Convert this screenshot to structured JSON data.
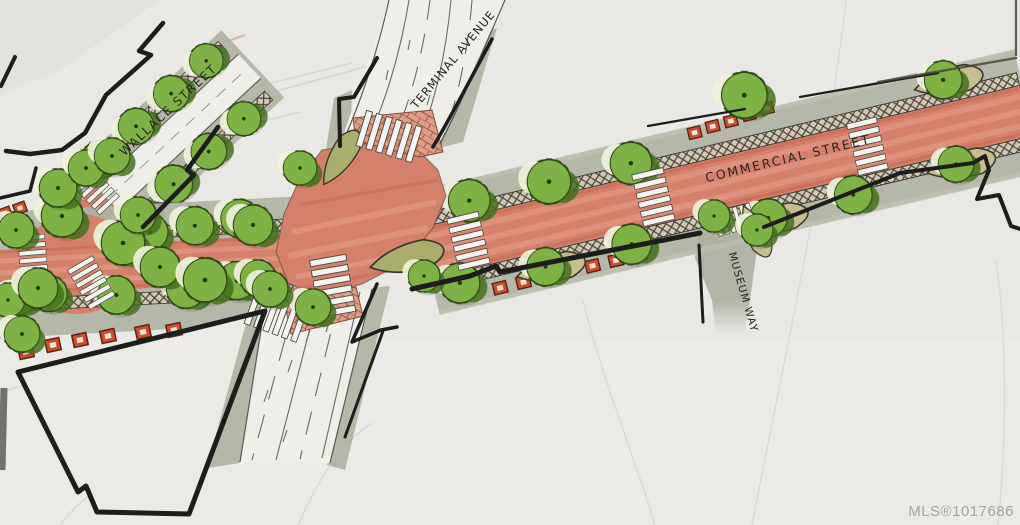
{
  "labels": {
    "wallace_street": "WALLACE STREET",
    "terminal_avenue": "TERMINAL AVENUE",
    "commercial_street": "COMMERCIAL STREET",
    "museum_way": "MUSEUM WAY"
  },
  "watermark": "MLS®1017686",
  "palette": {
    "paper": "#e9e8e4",
    "roadway_red": "#d5806a",
    "sidewalk_gray": "#b0b3a3",
    "tree_green": "#7fb244",
    "tree_green_dark": "#44711c",
    "bench_red": "#cc4e2e",
    "brick_salmon": "#dc9a83",
    "outline_black": "#1d1d1b"
  }
}
